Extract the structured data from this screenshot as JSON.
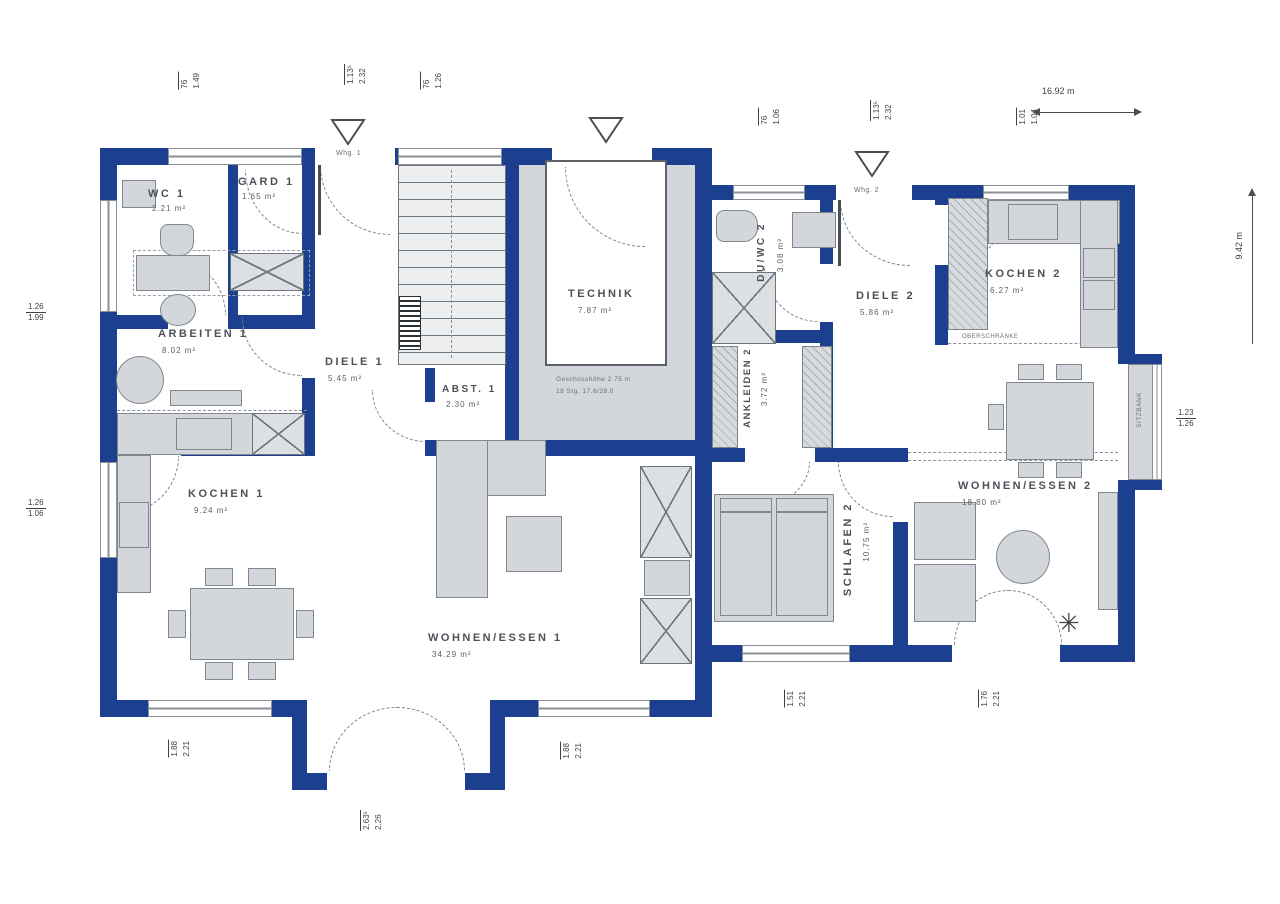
{
  "plan_title": "Erdgeschoss Grundriss – Haus mit Einliegerwohnung",
  "colors": {
    "wall": "#1c3f90",
    "furniture_fill": "#d3d7db",
    "furniture_stroke": "#81878e",
    "label_text": "#4b5157"
  },
  "rooms": {
    "wc1": {
      "name": "WC 1",
      "area": "2.21 m²"
    },
    "gard1": {
      "name": "GARD 1",
      "area": "1.65 m²"
    },
    "arbeiten1": {
      "name": "ARBEITEN 1",
      "area": "8.02 m²"
    },
    "diele1": {
      "name": "DIELE 1",
      "area": "5.45 m²"
    },
    "abst1": {
      "name": "ABST. 1",
      "area": "2.30 m²"
    },
    "technik": {
      "name": "TECHNIK",
      "area": "7.87 m²"
    },
    "kochen1": {
      "name": "KOCHEN 1",
      "area": "9.24 m²"
    },
    "wohnen1": {
      "name": "WOHNEN/ESSEN 1",
      "area": "34.29 m²"
    },
    "duwc2": {
      "name": "DU/WC 2",
      "area": "3.08 m²"
    },
    "diele2": {
      "name": "DIELE 2",
      "area": "5.86 m²"
    },
    "kochen2": {
      "name": "KOCHEN 2",
      "area": "6.27 m²"
    },
    "ankleiden2": {
      "name": "ANKLEIDEN 2",
      "area": "3.72 m²"
    },
    "schlafen2": {
      "name": "SCHLAFEN 2",
      "area": "10.75 m²"
    },
    "wohnen2": {
      "name": "WOHNEN/ESSEN 2",
      "area": "18.80 m²"
    }
  },
  "entrances": {
    "e1": "Whg. 1",
    "e2": "Whg. 2"
  },
  "notes": {
    "technik_note1": "Geschosshöhe 2.75 m",
    "technik_note2": "18 Stg. 17.6/28.0",
    "kitchen2_note": "OBERSCHRÄNKE",
    "sitzbank": "SITZBANK"
  },
  "dimensions": {
    "overall_width": "16.92 m",
    "overall_height": "9.42 m",
    "tags": {
      "t1": {
        "a": "76",
        "b": "1.49"
      },
      "t2": {
        "a": "1.13⁵",
        "b": "2.32"
      },
      "t3": {
        "a": "76",
        "b": "1.26"
      },
      "t4": {
        "a": "76",
        "b": "1.06"
      },
      "t5": {
        "a": "1.13⁵",
        "b": "2.32"
      },
      "t6": {
        "a": "1.01",
        "b": "1.04"
      },
      "t7": {
        "a": "1.26",
        "b": "1.99"
      },
      "t8": {
        "a": "1.26",
        "b": "1.06"
      },
      "t9": {
        "a": "1.23",
        "b": "1.26"
      },
      "t10": {
        "a": "1.88",
        "b": "2.21"
      },
      "t11": {
        "a": "1.88",
        "b": "2.21"
      },
      "t12": {
        "a": "2.63⁵",
        "b": "2.26"
      },
      "t13": {
        "a": "1.51",
        "b": "2.21"
      },
      "t14": {
        "a": "1.76",
        "b": "2.21"
      }
    }
  }
}
